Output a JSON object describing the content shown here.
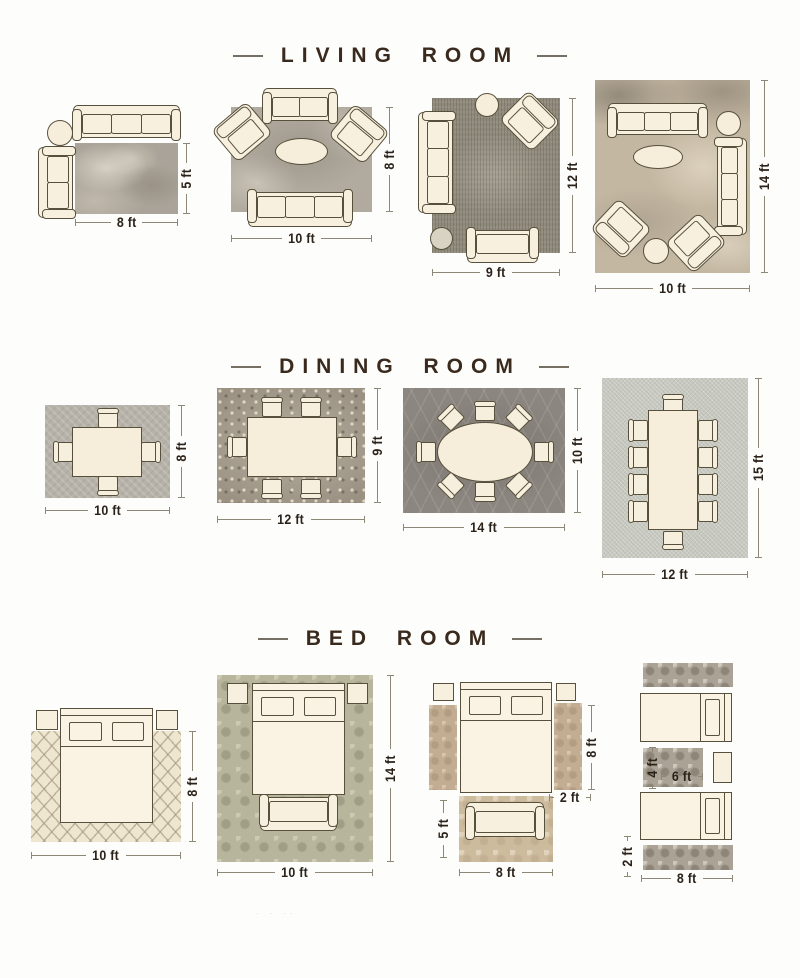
{
  "colors": {
    "background": "#fdfdfc",
    "heading_text": "#3a2a1d",
    "dimension_text": "#2b2219",
    "dimension_line": "#8d8778",
    "furniture_fill": "#f8f0de",
    "furniture_outline": "#57503c"
  },
  "watermark_dots": "· · ··",
  "sections": {
    "living": {
      "title": "LIVING ROOM",
      "layouts": [
        {
          "name": "8x5 rug with sofa, chaise and side table",
          "w": "8 ft",
          "h": "5 ft"
        },
        {
          "name": "10x8 rug with two sofas, two armchairs and oval coffee table",
          "w": "10 ft",
          "h": "8 ft"
        },
        {
          "name": "9x12 rug with sofa, loveseat, armchair, side table and pouf",
          "w": "9 ft",
          "h": "12 ft"
        },
        {
          "name": "10x14 rug with two sofas, two armchairs, coffee table and pouf",
          "w": "10 ft",
          "h": "14 ft"
        }
      ]
    },
    "dining": {
      "title": "DINING ROOM",
      "layouts": [
        {
          "name": "10x8 rug with square table for four",
          "w": "10 ft",
          "h": "8 ft"
        },
        {
          "name": "12x9 rug with rectangular table for six",
          "w": "12 ft",
          "h": "9 ft"
        },
        {
          "name": "14x10 rug with oval table for eight",
          "w": "14 ft",
          "h": "10 ft"
        },
        {
          "name": "12x15 rug with long table for ten",
          "w": "12 ft",
          "h": "15 ft"
        }
      ]
    },
    "bedroom": {
      "title": "BED ROOM",
      "layouts": [
        {
          "name": "10x8 rug under queen bed with nightstands",
          "w": "10 ft",
          "h": "8 ft"
        },
        {
          "name": "10x14 rug under bed with nightstands and bench",
          "w": "10 ft",
          "h": "14 ft"
        },
        {
          "name": "bed with two 2x8 side runners and 5x8 accent rug with bench",
          "side_h": "8 ft",
          "side_w": "2 ft",
          "accent_h": "5 ft",
          "accent_w": "8 ft"
        },
        {
          "name": "twin beds with 2x8 runners and 4x6 rug between",
          "mid_h": "4 ft",
          "mid_w": "6 ft",
          "runner_h": "2 ft",
          "runner_w": "8 ft"
        }
      ]
    }
  }
}
